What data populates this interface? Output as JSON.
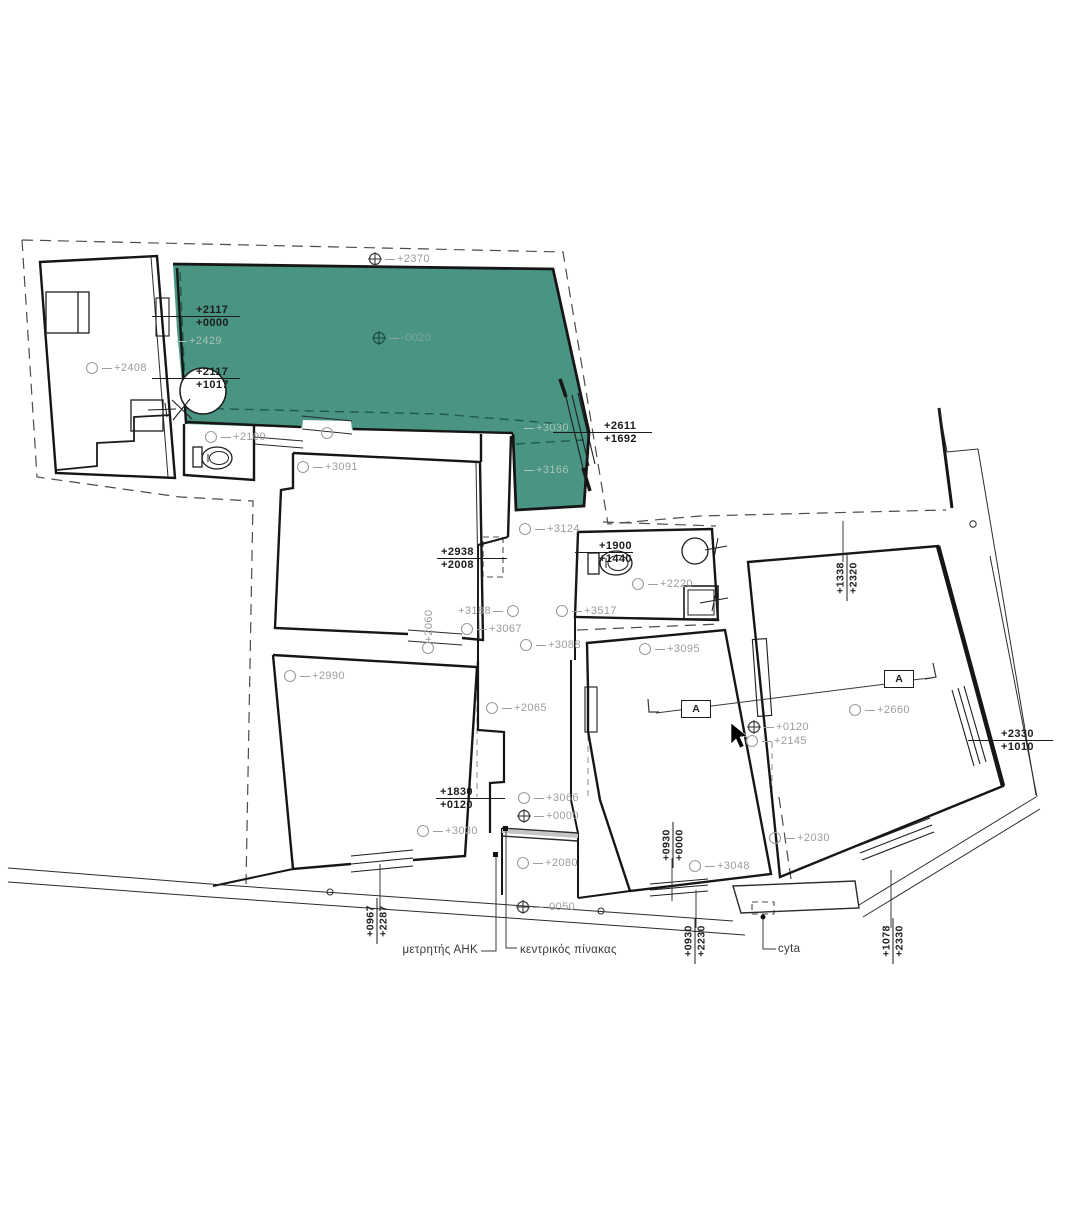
{
  "canvas": {
    "width": 1080,
    "height": 1226,
    "background": "#ffffff",
    "accent_green": "#4A9484",
    "annotation_gray": "#9c9c9c",
    "line_black": "#1c1c1c"
  },
  "plan": {
    "circle_labels": [
      {
        "symbol": "circle",
        "text": "+2408",
        "x": 92,
        "y": 368
      },
      {
        "symbol": "circle",
        "text": "+2100",
        "x": 211,
        "y": 437
      },
      {
        "symbol": "circle",
        "text": "+3091",
        "x": 303,
        "y": 467
      },
      {
        "symbol": "datum",
        "text": "+2370",
        "x": 375,
        "y": 259
      },
      {
        "symbol": "datum",
        "text": "-0020",
        "x": 379,
        "y": 338,
        "variant": "greendatum"
      },
      {
        "symbol": "circle",
        "text": "+3124",
        "x": 525,
        "y": 529
      },
      {
        "symbol": "circle",
        "text": "+3188",
        "x": 513,
        "y": 611,
        "flip": true
      },
      {
        "symbol": "circle",
        "text": "+3067",
        "x": 467,
        "y": 629
      },
      {
        "symbol": "circle",
        "text": "+3517",
        "x": 562,
        "y": 611
      },
      {
        "symbol": "circle",
        "text": "+2220",
        "x": 638,
        "y": 584
      },
      {
        "symbol": "circle",
        "text": "+3088",
        "x": 526,
        "y": 645
      },
      {
        "symbol": "circle",
        "text": "+3095",
        "x": 645,
        "y": 649
      },
      {
        "symbol": "circle",
        "text": "+2990",
        "x": 290,
        "y": 676
      },
      {
        "symbol": "circle",
        "text": "+2065",
        "x": 492,
        "y": 708
      },
      {
        "symbol": "circle",
        "text": "+2660",
        "x": 855,
        "y": 710
      },
      {
        "symbol": "datum",
        "text": "+0120",
        "x": 754,
        "y": 727
      },
      {
        "symbol": "circle",
        "text": "+2145",
        "x": 752,
        "y": 741
      },
      {
        "symbol": "circle",
        "text": "+3066",
        "x": 524,
        "y": 798
      },
      {
        "symbol": "datum",
        "text": "+0000",
        "x": 524,
        "y": 816
      },
      {
        "symbol": "circle",
        "text": "+3030",
        "x": 423,
        "y": 831
      },
      {
        "symbol": "circle",
        "text": "+2080",
        "x": 523,
        "y": 863
      },
      {
        "symbol": "datum",
        "text": "-0050",
        "x": 523,
        "y": 907
      },
      {
        "symbol": "circle",
        "text": "+2030",
        "x": 775,
        "y": 838
      },
      {
        "symbol": "circle",
        "text": "+3048",
        "x": 695,
        "y": 866
      },
      {
        "symbol": "none",
        "text": "+2429",
        "x": 183,
        "y": 341,
        "variant": "ghost"
      },
      {
        "symbol": "none",
        "text": "+3030",
        "x": 530,
        "y": 428,
        "variant": "ghost"
      },
      {
        "symbol": "none",
        "text": "+3166",
        "x": 530,
        "y": 470,
        "variant": "ghost"
      }
    ],
    "rotated_single": [
      {
        "text": "+2060",
        "x": 429,
        "y": 626
      }
    ],
    "elevation_pairs": [
      {
        "top": "+2117",
        "bottom": "+0000",
        "y": 317,
        "x1": 152,
        "x2": 240,
        "tx": 196
      },
      {
        "top": "+2117",
        "bottom": "+1017",
        "y": 379,
        "x1": 152,
        "x2": 240,
        "tx": 196
      },
      {
        "top": "+2611",
        "bottom": "+1692",
        "y": 433,
        "x1": 553,
        "x2": 652,
        "tx": 604
      },
      {
        "top": "+2938",
        "bottom": "+2008",
        "y": 559,
        "x1": 437,
        "x2": 507,
        "tx": 441
      },
      {
        "top": "+1900",
        "bottom": "+1440",
        "y": 553,
        "x1": 575,
        "x2": 633,
        "tx": 599
      },
      {
        "top": "+1830",
        "bottom": "+0120",
        "y": 799,
        "x1": 436,
        "x2": 505,
        "tx": 440
      },
      {
        "top": "+2330",
        "bottom": "+1010",
        "y": 741,
        "x1": 968,
        "x2": 1053,
        "tx": 1001
      }
    ],
    "rotated_pairs": [
      {
        "left": "+1338",
        "right": "+2320",
        "x": 847,
        "y": 578
      },
      {
        "left": "+0930",
        "right": "+0000",
        "x": 673,
        "y": 845
      },
      {
        "left": "+0930",
        "right": "+2230",
        "x": 695,
        "y": 941
      },
      {
        "left": "+1078",
        "right": "+2330",
        "x": 893,
        "y": 941
      },
      {
        "left": "+0967",
        "right": "+2287",
        "x": 377,
        "y": 921
      }
    ],
    "callouts": [
      {
        "text": "μετρητής ΑΗΚ",
        "x": 478,
        "y": 951,
        "align": "right"
      },
      {
        "text": "κεντρικός πίνακας",
        "x": 520,
        "y": 951,
        "align": "left"
      },
      {
        "text": "cyta",
        "x": 778,
        "y": 950,
        "align": "left"
      }
    ],
    "section_markers": [
      {
        "label": "A",
        "x": 696,
        "y": 709
      },
      {
        "label": "A",
        "x": 899,
        "y": 679
      }
    ]
  }
}
